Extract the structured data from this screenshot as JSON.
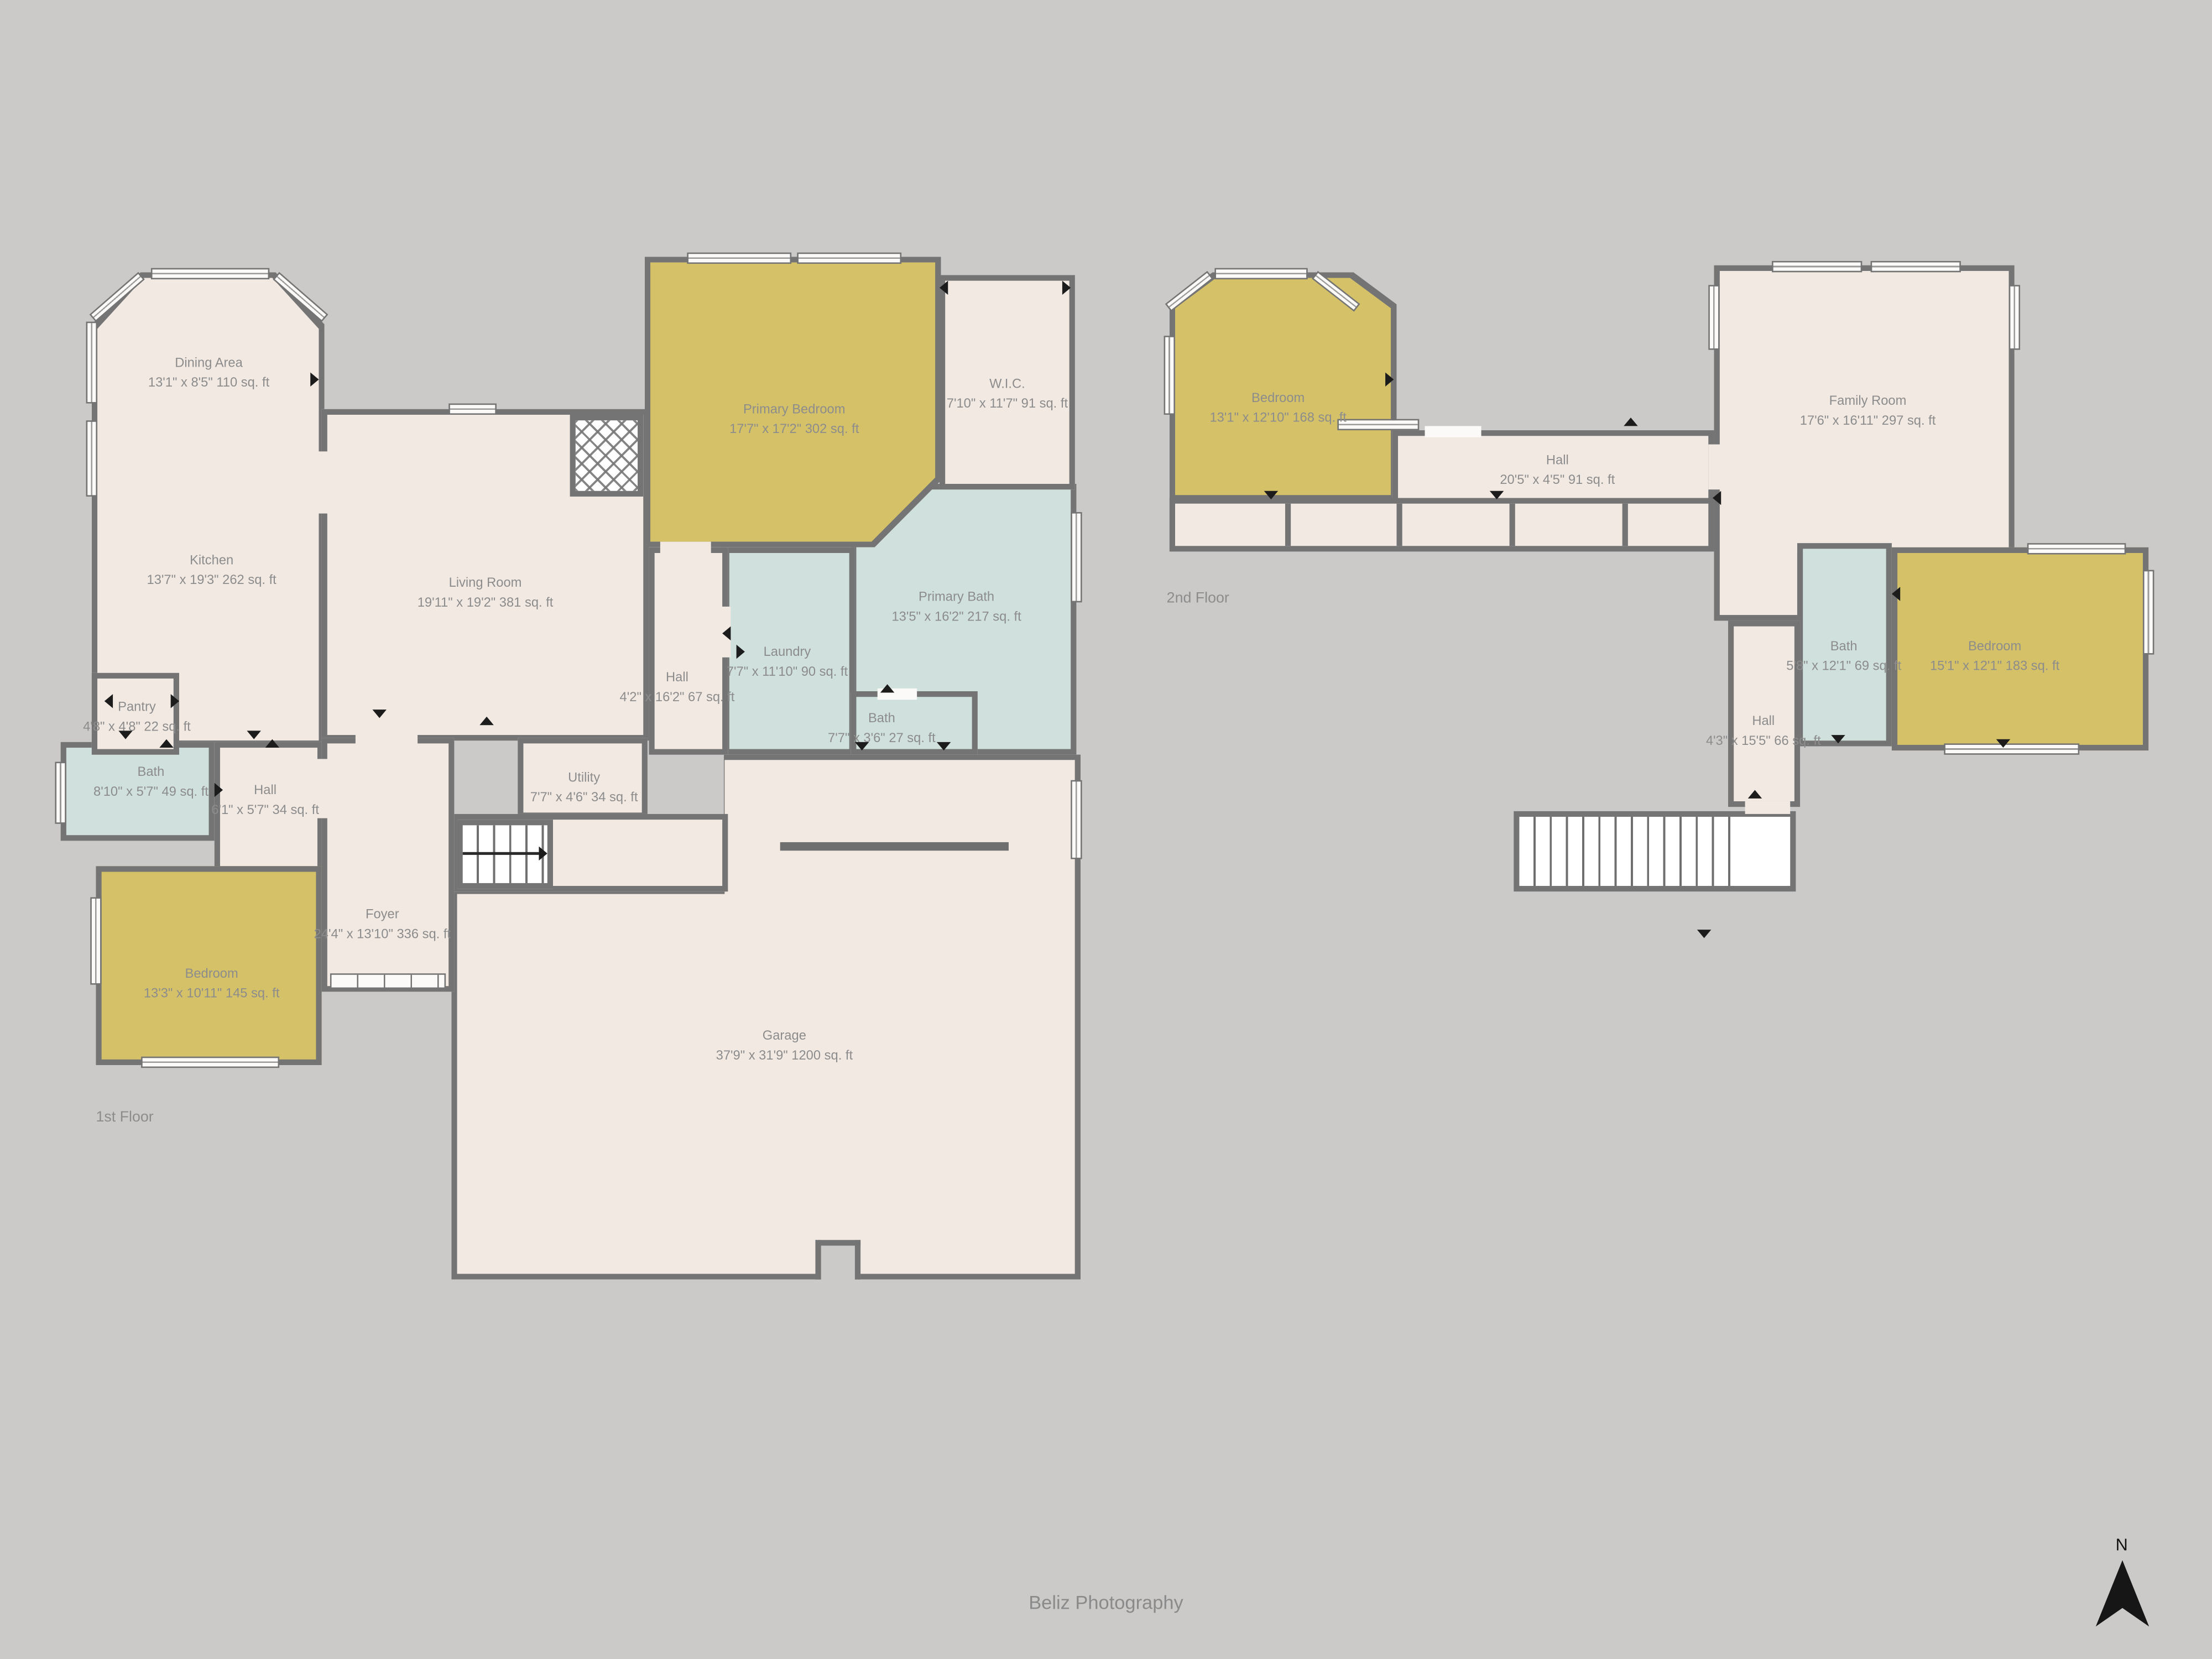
{
  "palette": {
    "background": "#cbcac9",
    "floor": "#f2e9e3",
    "bedroom_fill": "#d5c268",
    "bath_fill": "#cfe0dd",
    "wall": "#747474",
    "label_text": "#8c8c8c"
  },
  "floor1": {
    "label": "1st Floor",
    "rooms": {
      "dining": {
        "name": "Dining Area",
        "dims": "13'1\" x 8'5\" 110 sq. ft"
      },
      "kitchen": {
        "name": "Kitchen",
        "dims": "13'7\" x 19'3\" 262 sq. ft"
      },
      "living": {
        "name": "Living Room",
        "dims": "19'11\" x 19'2\" 381 sq. ft"
      },
      "primary_bedroom": {
        "name": "Primary Bedroom",
        "dims": "17'7\" x 17'2\" 302 sq. ft"
      },
      "wic": {
        "name": "W.I.C.",
        "dims": "7'10\" x 11'7\" 91 sq. ft"
      },
      "primary_bath": {
        "name": "Primary Bath",
        "dims": "13'5\" x 16'2\" 217 sq. ft"
      },
      "laundry": {
        "name": "Laundry",
        "dims": "7'7\" x 11'10\" 90 sq. ft"
      },
      "hall_main": {
        "name": "Hall",
        "dims": "4'2\" x 16'2\" 67 sq. ft"
      },
      "bath_small": {
        "name": "Bath",
        "dims": "7'7\" x 3'6\" 27 sq. ft"
      },
      "pantry": {
        "name": "Pantry",
        "dims": "4'8\" x 4'8\" 22 sq. ft"
      },
      "bath_left": {
        "name": "Bath",
        "dims": "8'10\" x 5'7\" 49 sq. ft"
      },
      "hall_small": {
        "name": "Hall",
        "dims": "6'1\" x 5'7\" 34 sq. ft"
      },
      "utility": {
        "name": "Utility",
        "dims": "7'7\" x 4'6\" 34 sq. ft"
      },
      "foyer": {
        "name": "Foyer",
        "dims": "24'4\" x 13'10\" 336 sq. ft"
      },
      "bedroom": {
        "name": "Bedroom",
        "dims": "13'3\" x 10'11\" 145 sq. ft"
      },
      "garage": {
        "name": "Garage",
        "dims": "37'9\" x 31'9\" 1200 sq. ft"
      }
    }
  },
  "floor2": {
    "label": "2nd Floor",
    "rooms": {
      "bedroom_left": {
        "name": "Bedroom",
        "dims": "13'1\" x 12'10\" 168 sq. ft"
      },
      "hall": {
        "name": "Hall",
        "dims": "20'5\" x 4'5\" 91 sq. ft"
      },
      "family": {
        "name": "Family Room",
        "dims": "17'6\" x 16'11\" 297 sq. ft"
      },
      "bath": {
        "name": "Bath",
        "dims": "5'8\" x 12'1\" 69 sq. ft"
      },
      "bedroom_right": {
        "name": "Bedroom",
        "dims": "15'1\" x 12'1\" 183 sq. ft"
      },
      "hall_lower": {
        "name": "Hall",
        "dims": "4'3\" x 15'5\" 66 sq. ft"
      }
    }
  },
  "footer": {
    "credit": "Beliz Photography"
  },
  "compass": {
    "label": "N"
  }
}
